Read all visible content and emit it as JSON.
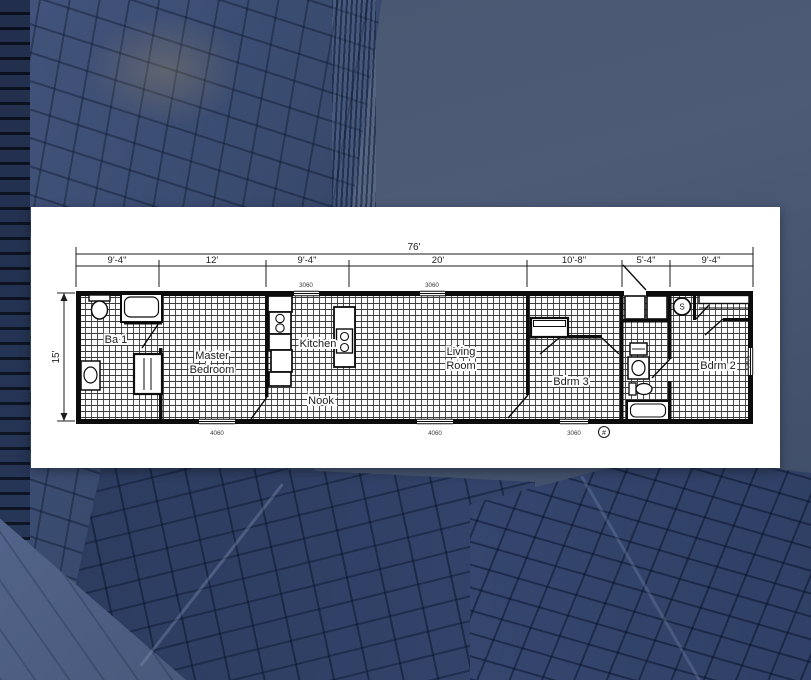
{
  "floorplan": {
    "dims": {
      "total": "76'",
      "height": "15'",
      "segments": [
        "9'-4\"",
        "12'",
        "9'-4\"",
        "20'",
        "10'-8\"",
        "5'-4\"",
        "9'-4\""
      ]
    },
    "rooms": {
      "ba1": "Ba 1",
      "master1": "Master",
      "master2": "Bedroom",
      "kitchen": "Kitchen",
      "nook": "Nook",
      "living1": "Living",
      "living2": "Room",
      "bdrm3": "Bdrm 3",
      "bdrm2": "Bdrm 2"
    },
    "windows": {
      "top_kitchen": "3060",
      "top_living": "3060",
      "bottom_master": "4060",
      "bottom_living": "4060",
      "bottom_bdrm3": "3060",
      "side_bdrm2": "3060"
    },
    "symbols": {
      "electric_panel": "#",
      "water_heater": "S"
    }
  }
}
